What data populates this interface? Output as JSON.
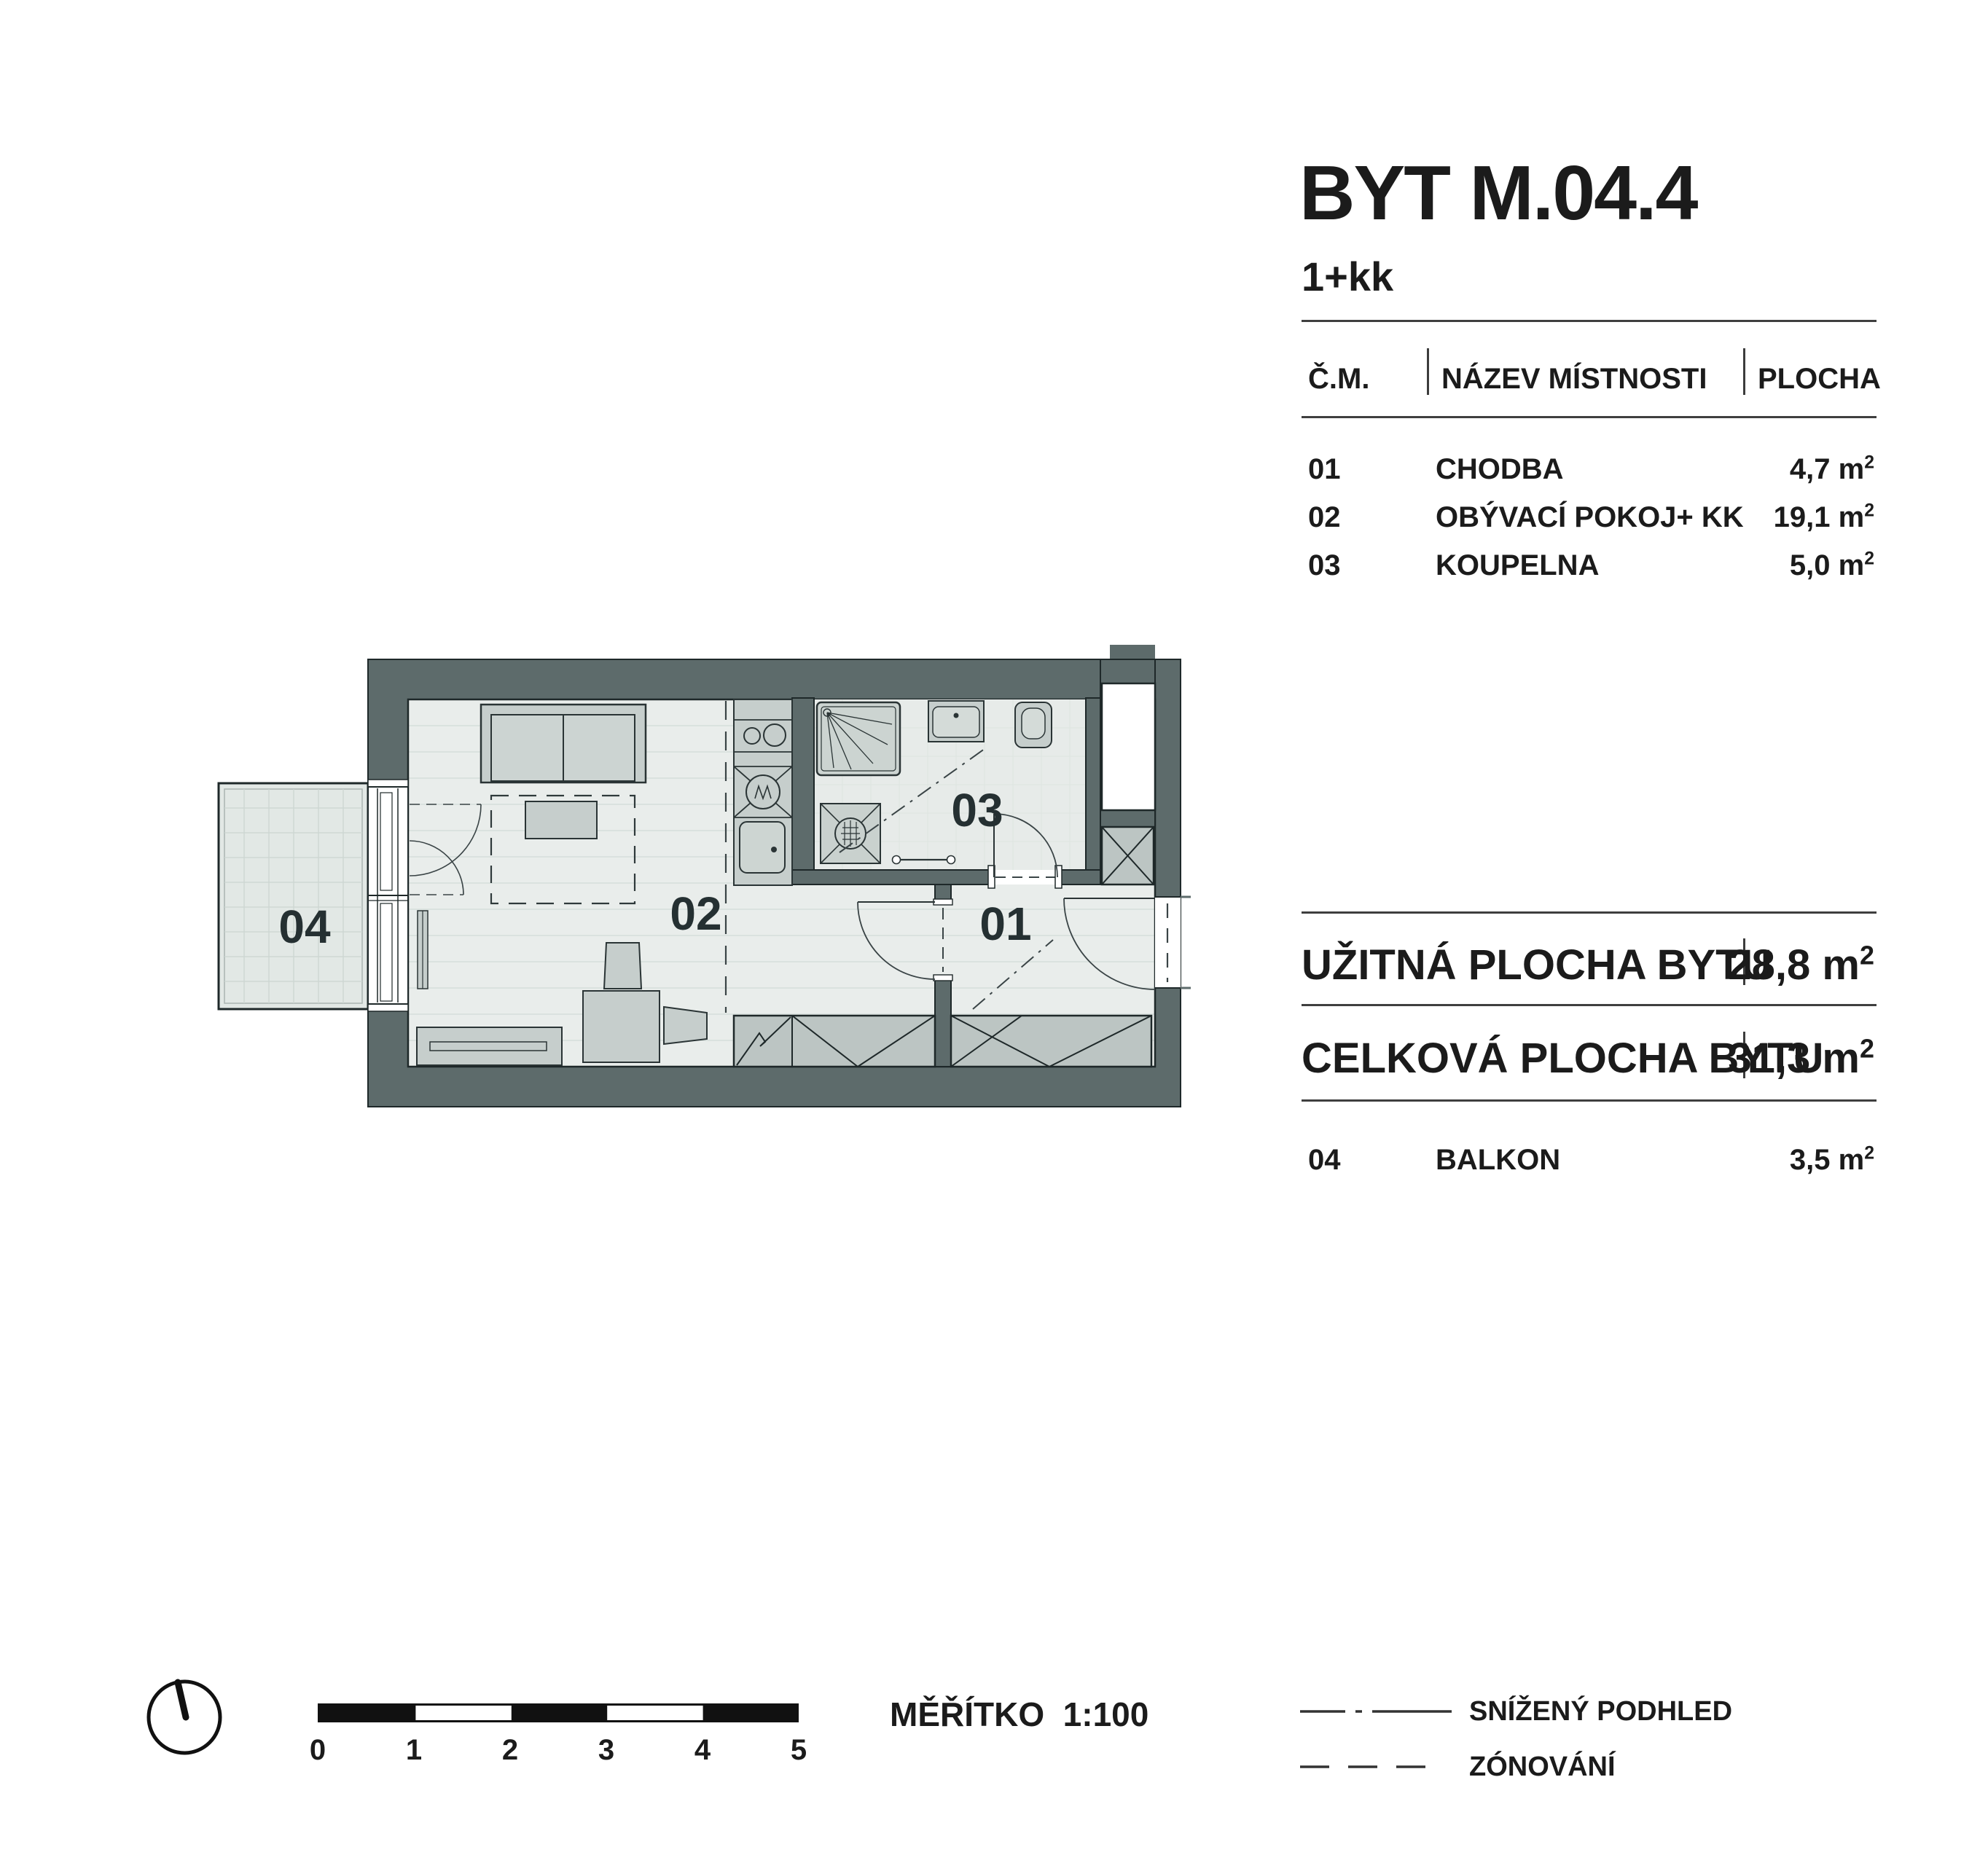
{
  "header": {
    "title": "BYT M.04.4",
    "subtitle": "1+kk"
  },
  "room_table": {
    "col_code": "Č.M.",
    "col_name": "NÁZEV MÍSTNOSTI",
    "col_area": "PLOCHA",
    "unit": "m",
    "unit_exp": "2",
    "rows": [
      {
        "code": "01",
        "name": "CHODBA",
        "area": "4,7"
      },
      {
        "code": "02",
        "name": "OBÝVACÍ POKOJ+ KK",
        "area": "19,1"
      },
      {
        "code": "03",
        "name": "KOUPELNA",
        "area": "5,0"
      }
    ]
  },
  "summary": {
    "rows": [
      {
        "label": "UŽITNÁ PLOCHA BYTU",
        "value": "28,8"
      },
      {
        "label": "CELKOVÁ PLOCHA BYTU",
        "value": "31,3"
      }
    ],
    "balcony": {
      "code": "04",
      "name": "BALKON",
      "area": "3,5"
    }
  },
  "plan": {
    "labels": {
      "hall": "01",
      "living": "02",
      "bath": "03",
      "balcony": "04"
    }
  },
  "footer": {
    "scale_label": "MĚŘÍTKO",
    "scale_value": "1:100",
    "ticks": [
      "0",
      "1",
      "2",
      "3",
      "4",
      "5"
    ],
    "legend": [
      {
        "label": "SNÍŽENÝ PODHLED"
      },
      {
        "label": "ZÓNOVÁNÍ"
      }
    ]
  },
  "colors": {
    "wall": "#5d6b6b",
    "floor": "#e9edeb",
    "bath_floor": "#e7ebe9",
    "balcony_floor": "#e2e8e5",
    "furniture": "#c6cecc",
    "wardrobe": "#bcc5c3",
    "line_dark": "#1e2829"
  }
}
